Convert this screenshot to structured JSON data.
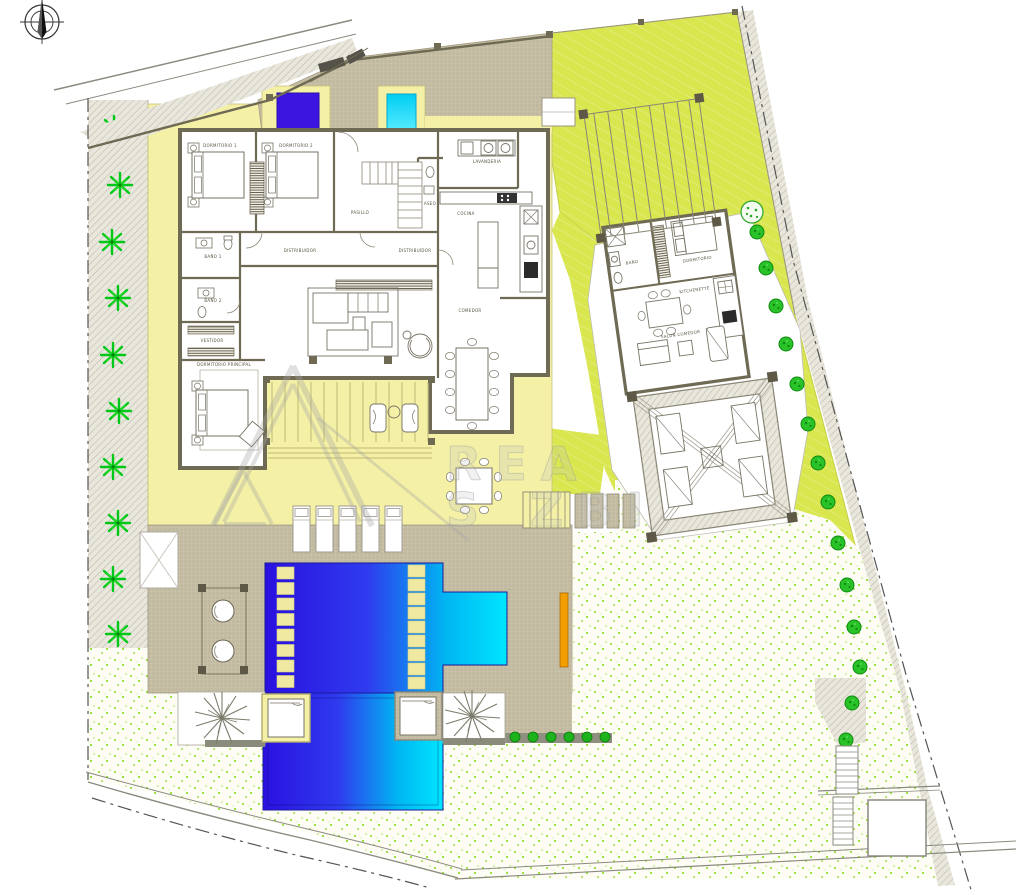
{
  "watermark": {
    "line1": "REA",
    "line2_left": "S",
    "line2_right": "ZBI"
  },
  "main_house": {
    "rooms": {
      "dormitorio1": "DORMITORIO 1",
      "dormitorio2": "DORMITORIO 2",
      "pasillo": "PASILLO",
      "distribuidor": "DISTRIBUIDOR",
      "distribuidor2": "DISTRIBUIDOR",
      "bano1": "BAÑO 1",
      "bano2": "BAÑO 2",
      "vestidor": "VESTIDOR",
      "dormitorio_principal": "DORMITORIO PRINCIPAL",
      "aseo": "ASEO",
      "lavanderia": "LAVANDERIA",
      "cocina": "COCINA",
      "comedor": "COMEDOR"
    }
  },
  "guest_house": {
    "rooms": {
      "bano": "BAÑO",
      "dormitorio": "DORMITORIO",
      "kitchenette": "KITCHENETTE",
      "salon_comedor": "SALON COMEDOR"
    }
  },
  "site_features": {
    "compass": "north-arrow",
    "sun_lounger_count": 5,
    "pool_cabana_count": 2,
    "left_palm_count": 10,
    "boundary_tree_count": 14,
    "water_feature_squares": 2,
    "pools": 2
  },
  "colors": {
    "terrace_yellow": "#f4f0a6",
    "lawn_chartreuse": "#d9e64e",
    "pool_deep_blue": "#2a12de",
    "pool_cyan": "#00e4ff",
    "water_square_blue": "#3b16e0",
    "water_square_cyan": "#19d8f5",
    "wall_olive": "#6f6a53",
    "deck_tan": "#cdc6ad",
    "palm_green": "#00c818",
    "tree_green": "#29c229",
    "bench_orange": "#f29d00"
  }
}
